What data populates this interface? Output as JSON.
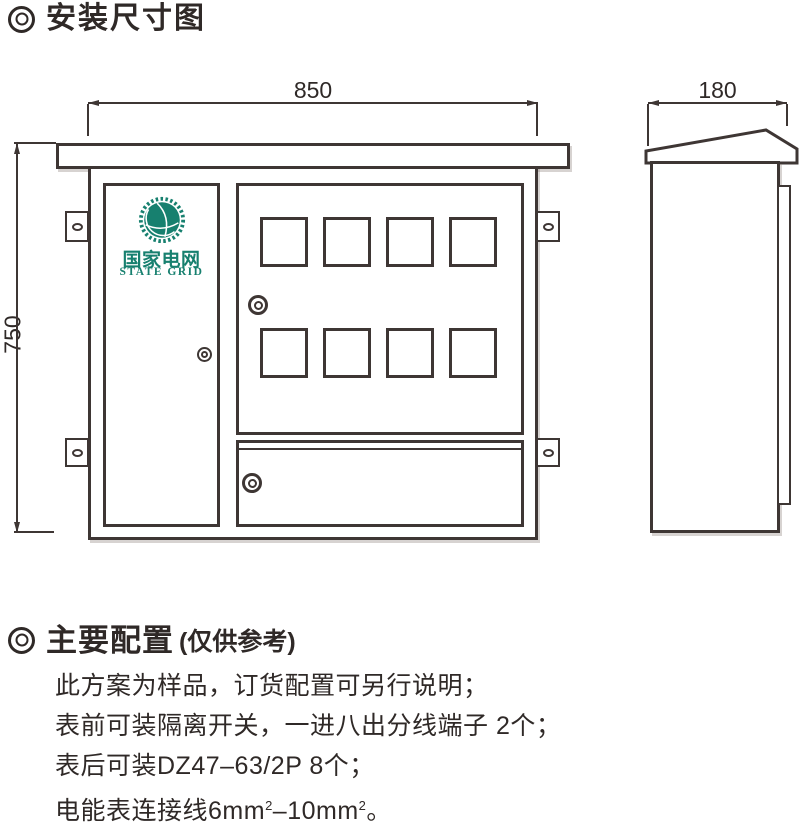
{
  "page": {
    "background": "#ffffff",
    "line_color": "#3e3634",
    "text_color": "#2f2927"
  },
  "header": {
    "title": "安装尺寸图"
  },
  "diagram": {
    "front_view": {
      "width_label": "850",
      "height_label": "750"
    },
    "side_view": {
      "depth_label": "180"
    },
    "logo": {
      "cn": "国家电网",
      "en": "STATE GRID",
      "color": "#17806f"
    }
  },
  "config": {
    "heading": "主要配置",
    "heading_note": "(仅供参考)",
    "lines": [
      "此方案为样品，订货配置可另行说明；",
      "表前可装隔离开关，一进八出分线端子 2个；",
      "表后可装DZ47–63/2P 8个；"
    ],
    "line4": {
      "p1": "电能表连接线6mm",
      "sup1": "2",
      "p2": "–10mm",
      "sup2": "2",
      "p3": "。"
    }
  }
}
